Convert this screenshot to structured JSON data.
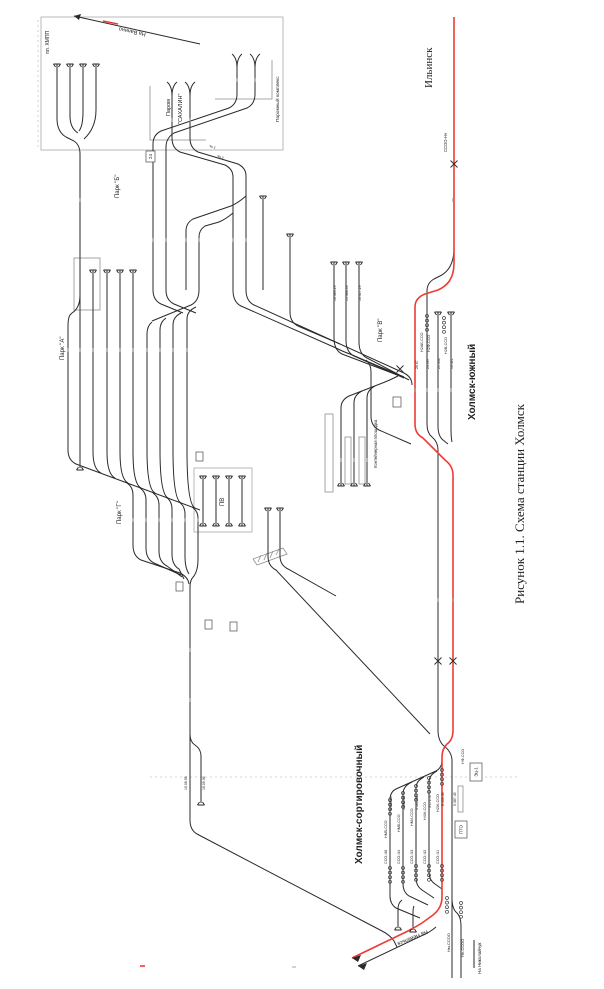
{
  "caption": "Рисунок 1.1. Схема станции Холмск",
  "stations": [
    "Ильинск",
    "Холмск-южный",
    "Холмск-сортировочный"
  ],
  "directions": [
    "На Ванино",
    "На Невельск",
    "На Николайчук"
  ],
  "yards": [
    "Парк \"А\"",
    "Парк \"Б\"",
    "Парк \"В\"",
    "Парк \"Г\""
  ],
  "facilities": [
    "Паром \"САХАЛИН\"",
    "Паромный комплекс",
    "Контейнерная площадка",
    "ПВ",
    "ПТО",
    "Эц-1",
    "пл. ХМПП"
  ],
  "diagram": {
    "size": [
      604,
      989
    ],
    "colors": {
      "track": "#2a2a2a",
      "main_red": "#ee3b34",
      "frame": "#b9b9b9",
      "platform": "#8f8f8f",
      "caption": "#1d1d26"
    },
    "labels": [
      {
        "t": "На Ванино",
        "x": 146,
        "y": 33,
        "s": 5.5,
        "r": 192,
        "n": "vanino-direction-label"
      },
      {
        "t": "пл. ХМПП",
        "x": 49,
        "y": 54,
        "s": 5,
        "n": "khmpp-platform-label"
      },
      {
        "t": "Паром",
        "x": 170,
        "y": 116,
        "s": 5.5,
        "n": "ferry-label-line1"
      },
      {
        "t": "\"САХАЛИН\"",
        "x": 182,
        "y": 124,
        "s": 5.5,
        "n": "ferry-label-line2"
      },
      {
        "t": "Паромный комплекс",
        "x": 279,
        "y": 122,
        "s": 4.8,
        "n": "ferry-complex-label"
      },
      {
        "t": "1 пь",
        "x": 216,
        "y": 147,
        "s": 3.5,
        "r": 197
      },
      {
        "t": "2 пь",
        "x": 224,
        "y": 157,
        "s": 3.5,
        "r": 197
      },
      {
        "t": "Парк \"Б\"",
        "x": 119,
        "y": 198,
        "s": 6,
        "n": "yard-b-label"
      },
      {
        "t": "Парк \"А\"",
        "x": 64,
        "y": 360,
        "s": 6,
        "n": "yard-a-label"
      },
      {
        "t": "Парк \"Г\"",
        "x": 121,
        "y": 524,
        "s": 6,
        "n": "yard-g-label"
      },
      {
        "t": "Парк \"В\"",
        "x": 382,
        "y": 342,
        "s": 6,
        "n": "yard-v-label"
      },
      {
        "t": "ПВ",
        "x": 224,
        "y": 506,
        "s": 6,
        "n": "pv-depot-label"
      },
      {
        "t": "Контейнерная площадка",
        "x": 377,
        "y": 468,
        "s": 4.2,
        "n": "container-area-label"
      },
      {
        "t": "Ильинск",
        "x": 432,
        "y": 88,
        "s": 11,
        "f": "serif",
        "n": "ilinsk-label"
      },
      {
        "t": "ССОО-Нч",
        "x": 447,
        "y": 152,
        "s": 4.2
      },
      {
        "t": "Холмск-южный",
        "x": 475,
        "y": 420,
        "s": 10,
        "w": 600,
        "n": "kholmsk-yuzhny-label"
      },
      {
        "t": "Холмск-сортировочный",
        "x": 362,
        "y": 864,
        "s": 10,
        "w": 600,
        "n": "kholmsk-sortirovochny-label"
      },
      {
        "t": "Рисунок 1.1. Схема станции Холмск",
        "x": 524,
        "y": 604,
        "s": 13,
        "f": "serif",
        "c": "#1d1d26",
        "n": "figure-caption"
      },
      {
        "t": "На Невельск",
        "x": 427,
        "y": 930,
        "s": 5.5,
        "r": 157,
        "n": "nevelsk-direction-label"
      },
      {
        "t": "На Николайчук",
        "x": 481,
        "y": 974,
        "s": 4.5,
        "n": "nikolaychuk-direction-label"
      },
      {
        "t": "Нм-ССОО",
        "x": 450,
        "y": 952,
        "s": 4
      },
      {
        "t": "Не-ССОО",
        "x": 464,
        "y": 957,
        "s": 4
      },
      {
        "t": "Н2АБ-ССО",
        "x": 423,
        "y": 352,
        "s": 3.8
      },
      {
        "t": "Н2Ф-ССО",
        "x": 430,
        "y": 352,
        "s": 3.8
      },
      {
        "t": "Н2В-ССО",
        "x": 447,
        "y": 354,
        "s": 3.8
      },
      {
        "t": "26.67",
        "x": 418,
        "y": 369,
        "s": 3.5
      },
      {
        "t": "23.397",
        "x": 429,
        "y": 369,
        "s": 3.5
      },
      {
        "t": "21.446",
        "x": 440,
        "y": 369,
        "s": 3.5
      },
      {
        "t": "16.421",
        "x": 453,
        "y": 369,
        "s": 3.5
      },
      {
        "t": "16.383.29",
        "x": 336,
        "y": 301,
        "s": 3.5
      },
      {
        "t": "15.488.33",
        "x": 348,
        "y": 301,
        "s": 3.5
      },
      {
        "t": "16.417.29",
        "x": 361,
        "y": 301,
        "s": 3.5
      },
      {
        "t": "НМ5-ССО",
        "x": 387,
        "y": 838,
        "s": 3.8
      },
      {
        "t": "НМ6-ССО",
        "x": 400,
        "y": 832,
        "s": 3.8
      },
      {
        "t": "НМ4-ССО",
        "x": 413,
        "y": 826,
        "s": 3.8
      },
      {
        "t": "Н4Ж-ССО",
        "x": 426,
        "y": 820,
        "s": 3.8
      },
      {
        "t": "Н2Ж-ССО",
        "x": 439,
        "y": 812,
        "s": 3.8
      },
      {
        "t": "НФ-ССО",
        "x": 464,
        "y": 764,
        "s": 3.8
      },
      {
        "t": "ССО-Ч6",
        "x": 387,
        "y": 864,
        "s": 3.8
      },
      {
        "t": "ССО-Ч4",
        "x": 400,
        "y": 864,
        "s": 3.8
      },
      {
        "t": "ССО-Ч3",
        "x": 413,
        "y": 864,
        "s": 3.8
      },
      {
        "t": "ССО-Ч2",
        "x": 426,
        "y": 864,
        "s": 3.8
      },
      {
        "t": "ССО-Ч1",
        "x": 439,
        "y": 864,
        "s": 3.8
      },
      {
        "t": "6.040.63",
        "x": 392,
        "y": 810,
        "s": 3.5
      },
      {
        "t": "5.600.44",
        "x": 405,
        "y": 810,
        "s": 3.5
      },
      {
        "t": "4.481.42",
        "x": 418,
        "y": 810,
        "s": 3.5
      },
      {
        "t": "3.172.47",
        "x": 431,
        "y": 808,
        "s": 3.5
      },
      {
        "t": "8.458.38",
        "x": 444,
        "y": 806,
        "s": 3.5
      },
      {
        "t": "5.387.45",
        "x": 456,
        "y": 806,
        "s": 3.5
      },
      {
        "t": "16.08.98",
        "x": 187,
        "y": 790,
        "s": 3.5
      },
      {
        "t": "16.09.36",
        "x": 205,
        "y": 790,
        "s": 3.5
      }
    ],
    "boxes": [
      {
        "x": 146,
        "y": 151,
        "w": 9,
        "h": 11,
        "t": "24"
      },
      {
        "x": 393,
        "y": 397,
        "w": 8,
        "h": 10,
        "t": ""
      },
      {
        "x": 176,
        "y": 582,
        "w": 7,
        "h": 9,
        "t": ""
      },
      {
        "x": 205,
        "y": 620,
        "w": 7,
        "h": 9,
        "t": ""
      },
      {
        "x": 230,
        "y": 622,
        "w": 7,
        "h": 9,
        "t": ""
      },
      {
        "x": 196,
        "y": 452,
        "w": 7,
        "h": 9,
        "t": ""
      },
      {
        "x": 470,
        "y": 763,
        "w": 12,
        "h": 18,
        "t": "Эц-1"
      },
      {
        "x": 455,
        "y": 821,
        "w": 12,
        "h": 17,
        "t": "ПТО"
      }
    ],
    "frames": [
      {
        "x": 41,
        "y": 17,
        "w": 242,
        "h": 133
      },
      {
        "x": 194,
        "y": 468,
        "w": 58,
        "h": 64
      }
    ],
    "platforms": [
      [
        74,
        258,
        26,
        52
      ],
      [
        325,
        414,
        8,
        78
      ],
      [
        345,
        437,
        6,
        47
      ],
      [
        359,
        437,
        6,
        47
      ],
      [
        458,
        786,
        5,
        26
      ]
    ],
    "red_paths": [
      "M454,17 V263 C454,279 447,286 438,290 L425,294 Q415,298 415,307 V424 Q415,434 423,438 L445,460 Q453,466 453,475 V730 Q453,740 447,744 Q442,749 442,757 V897 Q442,908 433,915 L422,923 Q414,928 406,932 L352,958",
      "M103,21 L118,24",
      "M140,966 H145"
    ],
    "track_paths": [
      "M57,64 V118 Q57,132 66,137 L74,141 Q80,145 80,154",
      "M70,64 V116 Q70,128 78,133",
      "M83,64 V112 Q83,126 79,131",
      "M96,64 V110 Q96,128 84,139",
      "M80,154 V468",
      "M80,295 Q80,308 72,313 L70,315 Q68,318 68,326 V450",
      "M93,270 V452",
      "M107,270 V452",
      "M120,270 V452",
      "M133,270 V452",
      "M172,96 V138",
      "M190,96 V138",
      "M237,66 V94",
      "M255,66 V94",
      "M172,138 Q172,148 180,152 L225,165 Q233,169 233,177 V290",
      "M190,138 Q190,148 198,152 L238,164 Q246,168 246,176 V290",
      "M237,94 Q237,104 229,108 L161,131 Q153,135 153,144 V290",
      "M255,94 Q255,104 247,108 L174,133 Q166,138 166,147 V290",
      "M246,196 Q238,203 231,206 L193,219 Q186,223 186,231 V290",
      "M233,213 Q226,219 219,222 L205,226 Q199,230 199,237 V290",
      "M263,196 V290",
      "M290,234 V312 Q290,322 298,326 L340,344",
      "M246,290 Q246,301 254,305 L404,373 Q412,377 412,385",
      "M233,290 Q233,302 241,306 L336,348 Q344,352 350,354 L404,377",
      "M199,290 Q199,301 191,305 L152,321",
      "M196,307 Q187,311 187,319 V450",
      "M181,313 Q173,317 173,325 V450",
      "M166,318 Q160,322 160,330 V450",
      "M152,322 Q147,326 147,334 V450",
      "M153,290 Q153,300 161,304 L183,313",
      "M166,290 Q166,300 174,304 L196,313",
      "M68,450 Q68,460 76,464 L200,510",
      "M93,452 Q93,469 101,473",
      "M107,452 Q107,474 115,478",
      "M120,452 Q120,479 128,483",
      "M133,452 Q133,484 141,488",
      "M147,450 Q147,489 155,493",
      "M160,450 Q160,494 168,498",
      "M173,450 Q173,499 181,503",
      "M187,450 Q187,504 195,508",
      "M127,483 Q133,487 133,495 V545",
      "M140,488 Q146,492 146,500 V548",
      "M153,493 Q159,497 159,505 V551",
      "M166,497 Q172,501 172,509 V554",
      "M179,502 Q185,506 185,514 V557",
      "M192,507 Q198,511 198,518 V560",
      "M133,545 Q133,556 141,560 L180,573 Q188,577 189,584",
      "M146,548 Q146,559 154,563 L181,575",
      "M159,551 Q159,562 167,566 L182,577",
      "M172,554 Q172,565 179,569 L184,579",
      "M185,557 Q185,568 189,574",
      "M198,560 Q198,570 194,576 Q190,580 190,586",
      "M190,586 V820 Q190,830 197,834 L382,931 Q390,935 394,941 L397,947",
      "M190,734 Q190,742 195,745 Q201,749 201,756 V803",
      "M203,476 V526",
      "M216,476 V526",
      "M229,476 V526",
      "M242,476 V526",
      "M268,508 V556",
      "M280,508 V556",
      "M268,556 Q268,566 276,570 L430,734",
      "M280,556 Q280,565 288,569 L336,596",
      "M454,248 C454,264 448,272 440,276 L434,279 Q427,283 427,291 V424 Q427,433 432,437 Q438,442 438,450 V730 Q438,741 444,746 Q452,752 452,761 V978",
      "M452,898 Q452,909 457,913 Q461,917 461,926 V978",
      "M438,312 V426 Q438,436 443,440 L448,444",
      "M451,312 V428 Q451,438 452,442",
      "M398,376 Q390,380 385,382 L349,396 Q341,400 341,408 V486",
      "M362,391 Q354,395 354,403 V486",
      "M375,386 Q367,390 367,398 V486",
      "M334,262 V338 Q334,350 342,354 L400,376",
      "M346,262 V340 Q346,352 354,356 L404,378",
      "M359,262 V342 Q359,354 367,358 L409,380",
      "M366,360 Q371,364 371,372 V416 Q371,426 379,430 L411,444",
      "M442,760 Q442,768 436,771 L396,789 Q390,792 390,800 V896 Q390,904 396,908 L420,918",
      "M412,782 Q403,786 403,794 V884 Q403,892 409,896 L428,905",
      "M424,777 Q416,781 416,788 V878 Q416,886 422,890 L434,898",
      "M437,771 Q429,775 429,782 V872 Q429,880 435,884 L442,889",
      "M402,900 Q398,903 398,909 V928",
      "M414,906 Q413,908 413,913 V930",
      "M436,927 Q429,933 421,936 L358,966",
      "M474,940 V968",
      "M200,44 L74,16"
    ],
    "gray_paths": [
      "M150,86 V140 H206",
      "M215,99 H272 V60",
      "M253,559 L283,548 L287,554 L257,565 Z",
      "M258,562 L261,555",
      "M264,560 L267,553",
      "M270,558 L273,551",
      "M276,555 L279,549",
      "M292,967 H296"
    ],
    "dashed_paths": [
      "M38,20 V150",
      "M150,777 H520"
    ],
    "signals": [
      [
        427,
        316
      ],
      [
        444,
        318
      ],
      [
        390,
        800
      ],
      [
        403,
        793
      ],
      [
        416,
        786
      ],
      [
        429,
        778
      ],
      [
        442,
        770
      ],
      [
        390,
        868
      ],
      [
        403,
        868
      ],
      [
        416,
        866
      ],
      [
        429,
        866
      ],
      [
        442,
        866
      ],
      [
        447,
        898
      ],
      [
        461,
        903
      ]
    ],
    "buffers": [
      [
        57,
        64,
        1
      ],
      [
        70,
        64,
        1
      ],
      [
        83,
        64,
        1
      ],
      [
        96,
        64,
        1
      ],
      [
        93,
        270,
        1
      ],
      [
        107,
        270,
        1
      ],
      [
        120,
        270,
        1
      ],
      [
        133,
        270,
        1
      ],
      [
        263,
        196,
        1
      ],
      [
        290,
        234,
        1
      ],
      [
        334,
        262,
        1
      ],
      [
        346,
        262,
        1
      ],
      [
        359,
        262,
        1
      ],
      [
        438,
        312,
        1
      ],
      [
        451,
        312,
        1
      ],
      [
        203,
        476,
        1
      ],
      [
        216,
        476,
        1
      ],
      [
        229,
        476,
        1
      ],
      [
        242,
        476,
        1
      ],
      [
        268,
        508,
        1
      ],
      [
        280,
        508,
        1
      ],
      [
        80,
        470,
        -1
      ],
      [
        341,
        486,
        -1
      ],
      [
        354,
        486,
        -1
      ],
      [
        367,
        486,
        -1
      ],
      [
        203,
        526,
        -1
      ],
      [
        216,
        526,
        -1
      ],
      [
        229,
        526,
        -1
      ],
      [
        242,
        526,
        -1
      ],
      [
        201,
        805,
        -1
      ],
      [
        398,
        930,
        -1
      ],
      [
        413,
        932,
        -1
      ]
    ],
    "funnels": [
      [
        172,
        90
      ],
      [
        190,
        90
      ],
      [
        237,
        62
      ],
      [
        255,
        62
      ]
    ],
    "marks": [
      [
        454,
        164
      ],
      [
        438,
        661
      ],
      [
        453,
        661
      ],
      [
        400,
        369
      ]
    ],
    "arrows": [
      [
        74,
        16,
        81,
        14,
        79,
        20
      ],
      [
        352,
        958,
        361,
        955,
        358,
        962
      ],
      [
        358,
        966,
        367,
        963,
        364,
        970
      ]
    ],
    "ticks": [
      [
        68,
        350
      ],
      [
        80,
        350
      ],
      [
        93,
        350
      ],
      [
        107,
        350
      ],
      [
        120,
        350
      ],
      [
        133,
        350
      ],
      [
        147,
        350
      ],
      [
        160,
        350
      ],
      [
        173,
        350
      ],
      [
        187,
        350
      ],
      [
        133,
        520
      ],
      [
        146,
        520
      ],
      [
        159,
        520
      ],
      [
        172,
        520
      ],
      [
        185,
        520
      ],
      [
        198,
        520
      ],
      [
        153,
        240
      ],
      [
        166,
        240
      ],
      [
        186,
        240
      ],
      [
        199,
        240
      ],
      [
        233,
        240
      ],
      [
        246,
        240
      ],
      [
        415,
        390
      ],
      [
        427,
        390
      ],
      [
        438,
        390
      ],
      [
        451,
        390
      ],
      [
        172,
        120
      ],
      [
        190,
        120
      ],
      [
        237,
        80
      ],
      [
        255,
        80
      ],
      [
        341,
        460
      ],
      [
        354,
        460
      ],
      [
        367,
        460
      ],
      [
        80,
        200
      ],
      [
        190,
        650
      ],
      [
        190,
        700
      ],
      [
        453,
        600
      ],
      [
        438,
        600
      ],
      [
        453,
        200
      ]
    ]
  }
}
